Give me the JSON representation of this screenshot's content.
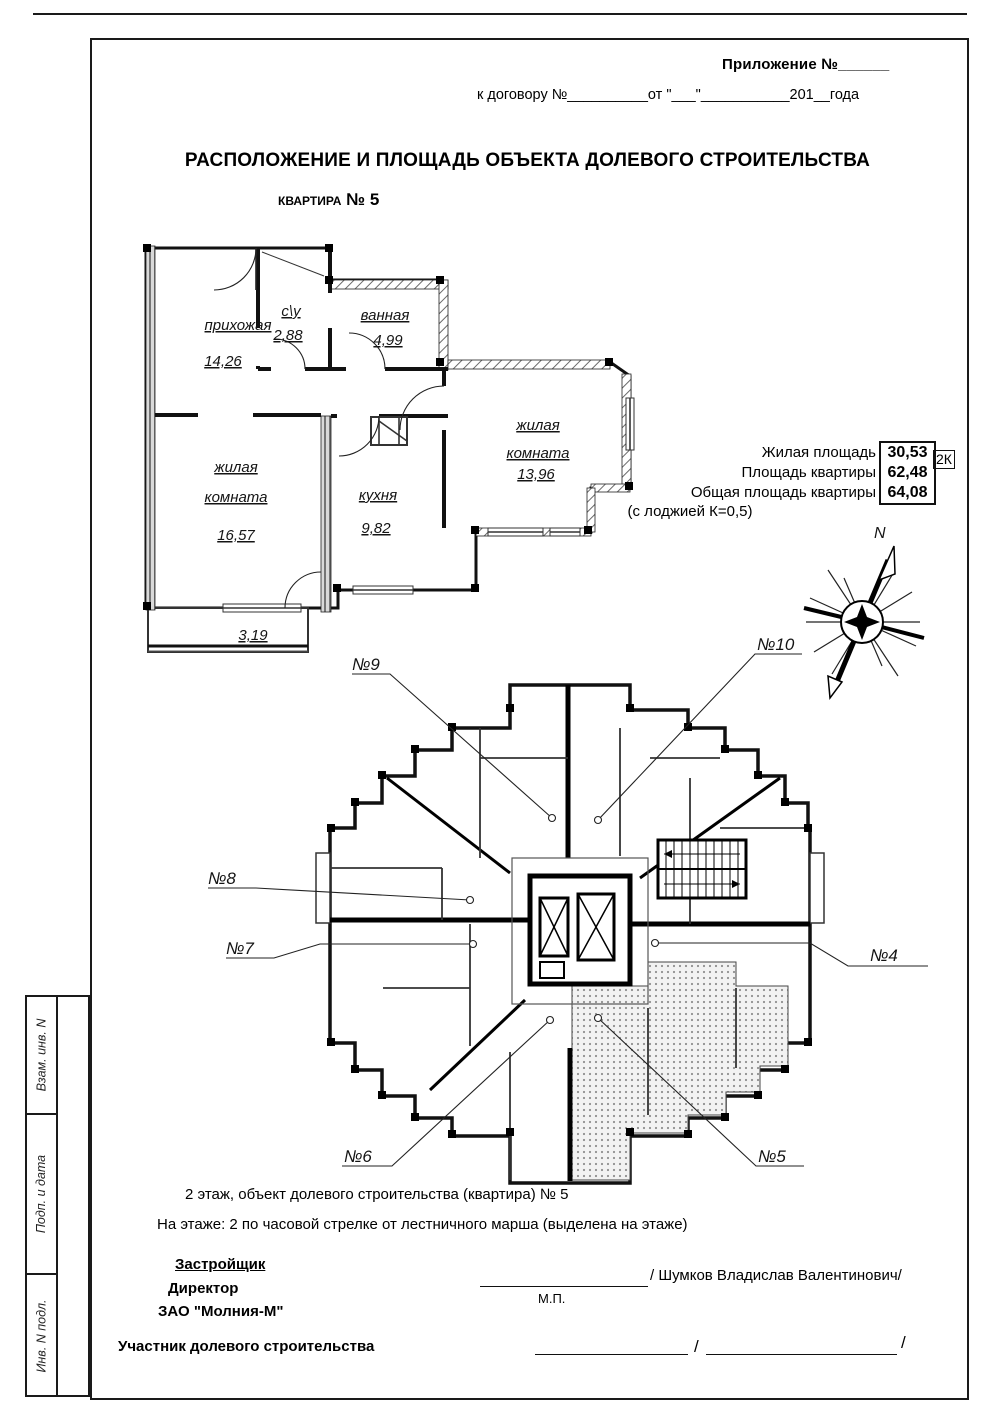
{
  "header": {
    "appendix": "Приложение №______",
    "contract": "к договору №__________от \"___\"___________201__года",
    "title": "РАСПОЛОЖЕНИЕ И ПЛОЩАДЬ ОБЪЕКТА ДОЛЕВОГО СТРОИТЕЛЬСТВА",
    "subtitle": "квартира № 5"
  },
  "apartment_plan": {
    "hallway_name": "прихожая",
    "hallway_area": "14,26",
    "wc_name": "с\\у",
    "wc_area": "2,88",
    "bath_name": "ванная",
    "bath_area": "4,99",
    "living1_line1": "жилая",
    "living1_line2": "комната",
    "living1_area": "16,57",
    "kitchen_name": "кухня",
    "kitchen_area": "9,82",
    "living2_line1": "жилая",
    "living2_line2": "комната",
    "living2_area": "13,96",
    "loggia_area": "3,19"
  },
  "area_summary": {
    "row1_label": "Жилая площадь",
    "row1_value": "30,53",
    "row2_label": "Площадь квартиры",
    "row2_value": "62,48",
    "row3_label": "Общая площадь квартиры",
    "row3_value": "64,08",
    "note": "(с лоджией К=0,5)",
    "badge": "2К"
  },
  "compass": {
    "north": "N"
  },
  "floor_plan": {
    "labels": {
      "n4": "№4",
      "n5": "№5",
      "n6": "№6",
      "n7": "№7",
      "n8": "№8",
      "n9": "№9",
      "n10": "№10"
    }
  },
  "footer": {
    "floor_line": "2 этаж, объект долевого строительства (квартира) № 5",
    "position_line": "На этаже:  2 по часовой стрелке от лестничного марша (выделена на этаже)",
    "developer_heading": "Застройщик",
    "developer_role": "Директор",
    "developer_company": "ЗАО \"Молния-М\"",
    "developer_sign": "/ Шумков Владислав Валентинович/",
    "stamp_mark": "М.П.",
    "participant_label": "Участник долевого строительства",
    "slash1": "/",
    "slash2": "/"
  },
  "stamp_column": {
    "row1": "Взам. инв. N",
    "row2": "Подп. и дата",
    "row3": "Инв. N подл."
  }
}
